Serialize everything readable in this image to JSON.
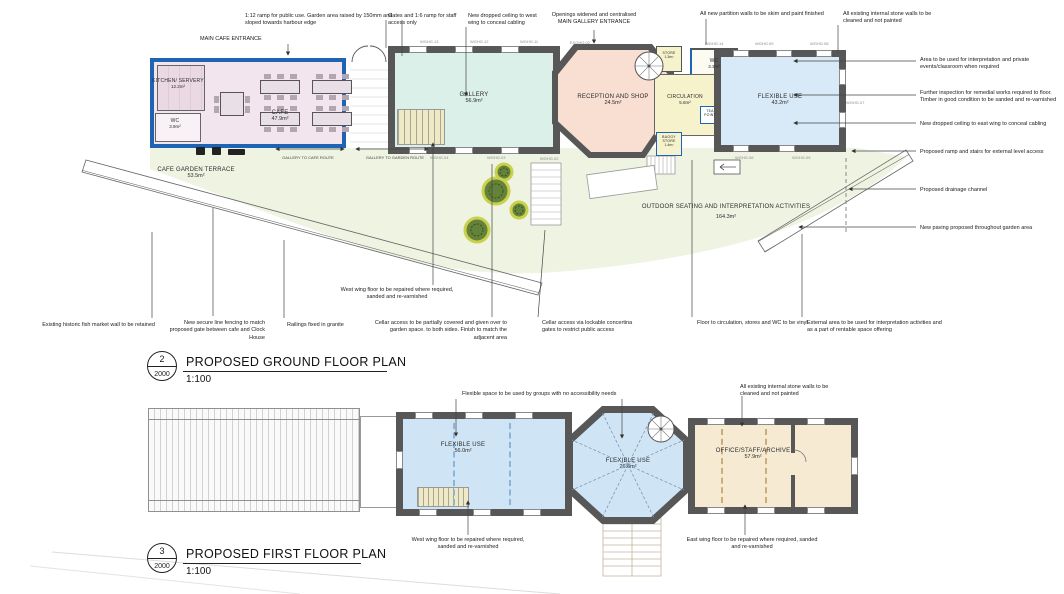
{
  "colors": {
    "new_work_blue": "#1f63b5",
    "wall_gray": "#575757",
    "cafe_fill": "#f2e5ee",
    "gallery_fill": "#dbf0e9",
    "reception_fill": "#f9ded2",
    "circulation_fill": "#f5f2cc",
    "flexible_fill": "#d8e9f7",
    "garden_fill": "#eef3e2",
    "office_fill": "#f6ead3"
  },
  "ground": {
    "title": {
      "number": "2",
      "sheet": "2000",
      "label": "PROPOSED GROUND FLOOR PLAN",
      "scale": "1:100"
    },
    "rooms": {
      "kitchen": {
        "name": "KITCHEN/ SERVERY",
        "area": "12.2m²"
      },
      "wc_cafe": {
        "name": "WC",
        "area": "3.9m²"
      },
      "cafe": {
        "name": "CAFE",
        "area": "47.9m²"
      },
      "gallery": {
        "name": "GALLERY",
        "area": "56.9m²"
      },
      "reception": {
        "name": "RECEPTION AND SHOP",
        "area": "24.5m²"
      },
      "store": {
        "name": "STORE",
        "area": "1.3m²"
      },
      "circulation": {
        "name": "CIRCULATION",
        "area": "5.6m²"
      },
      "wc_east": {
        "name": "WC",
        "area": "3.3m²"
      },
      "tea_point": {
        "name": "TEA POINT"
      },
      "buggy_store": {
        "name": "BUGGY STORE",
        "area": "1.4m²"
      },
      "flexible": {
        "name": "FLEXIBLE USE",
        "area": "43.2m²"
      },
      "terrace": {
        "name": "CAFE GARDEN TERRACE",
        "area": "53.5m²"
      },
      "outdoor": {
        "name": "OUTDOOR SEATING AND INTERPRETATION ACTIVITIES",
        "area": "164.3m²"
      }
    },
    "routes": [
      "GALLERY TO CAFE ROUTE",
      "GALLERY TO GARDEN ROUTE"
    ],
    "entrances": {
      "cafe": "MAIN CAFE ENTRANCE",
      "gallery_line1": "Openings widened and centralised",
      "gallery_line2": "MAIN GALLERY ENTRANCE"
    },
    "notes_top": [
      "1:12 ramp for public use. Garden area raised by 150mm and sloped towards harbour edge",
      "Gates and 1:6 ramp for staff access only",
      "New dropped ceiling to west wing to conceal cabling",
      "All new partition walls to be skim and paint finished",
      "All existing internal stone walls to be cleaned and not painted"
    ],
    "notes_right": [
      "Area to be used for interpretation and private events/classroom when required",
      "Further inspection for remedial works required to floor. Timber in good condition to be sanded and re-varnished",
      "New dropped ceiling to east wing to conceal cabling",
      "Proposed ramp and stairs for external level access",
      "Proposed drainage channel",
      "New paving proposed throughout garden area"
    ],
    "notes_bottom": [
      "Existing historic fish market wall to be retained",
      "New secure line fencing to match proposed gate between cafe and Clock House",
      "Railings fixed in granite",
      "West wing floor to be repaired where required, sanded and re-varnished",
      "Cellar access to be partially covered and given over to garden space. to both sides. Finish to match the adjacent area",
      "Cellar access via lockable concertina gates to restrict public access",
      "Floor to circulation, stores and WC to be vinyl",
      "External area to be used for interpretation activities and as a part of rentable space offering"
    ],
    "window_tags": [
      "WGHG.13",
      "WGHG.12",
      "WGHG.11",
      "EXGHG.02",
      "WGHG.14",
      "WGHG.09",
      "WGHG.08",
      "WGHG.07",
      "WGHG.04",
      "WGHG.03",
      "WGHG.02",
      "WGHG.06",
      "WGHG.05"
    ]
  },
  "first": {
    "title": {
      "number": "3",
      "sheet": "2000",
      "label": "PROPOSED FIRST FLOOR PLAN",
      "scale": "1:100"
    },
    "rooms": {
      "west": {
        "name": "FLEXIBLE USE",
        "area": "56.0m²"
      },
      "octagon": {
        "name": "FLEXIBLE USE",
        "area": "26.6m²"
      },
      "east": {
        "name": "OFFICE/STAFF/ARCHIVE",
        "area": "57.9m²"
      }
    },
    "notes": [
      "Flexible space to be used by groups with no accessibility needs",
      "All existing internal stone walls to be cleaned and not painted",
      "West wing floor to be repaired where required, sanded and re-varnished",
      "East wing floor to be repaired where required, sanded and re-varnished"
    ]
  }
}
